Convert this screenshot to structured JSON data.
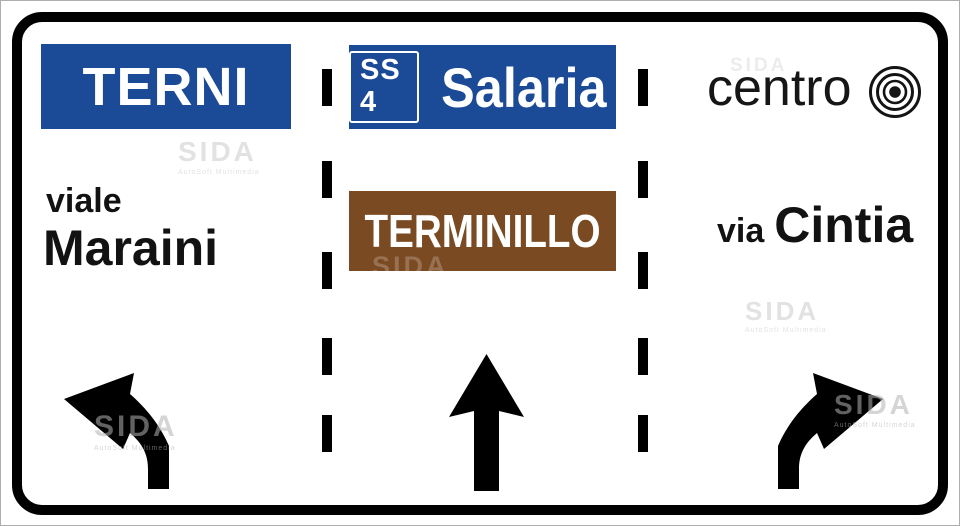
{
  "sign_type": "advance-direction-lane-sign",
  "colors": {
    "panel_blue": "#1b4a97",
    "panel_brown": "#7a4a22",
    "sign_black": "#000000",
    "sign_white": "#ffffff"
  },
  "left_lane": {
    "destination_panel": "TERNI",
    "street_prefix": "viale",
    "street_name": "Maraini",
    "arrow_icon": "turn-left-arrow"
  },
  "center_lane": {
    "route_badge": "SS 4",
    "route_name": "Salaria",
    "secondary_panel": "TERMINILLO",
    "arrow_icon": "straight-ahead-arrow"
  },
  "right_lane": {
    "destination": "centro",
    "destination_icon": "city-center-bullseye",
    "street_prefix": "via",
    "street_name": "Cintia",
    "arrow_icon": "turn-right-arrow"
  },
  "watermark": {
    "text": "SIDA",
    "subtext": "AutoSoft Multimedia"
  }
}
